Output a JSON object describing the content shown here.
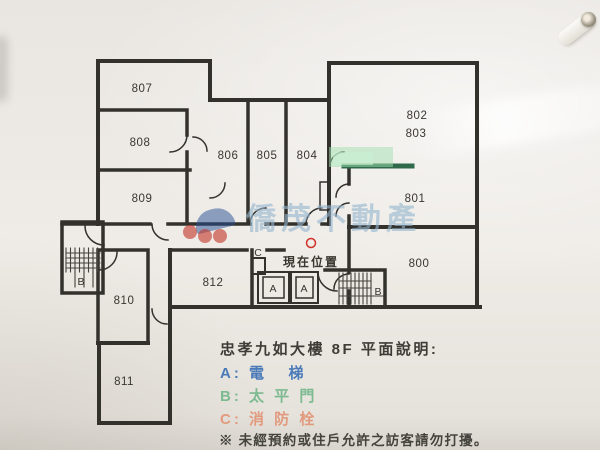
{
  "floor_plan": {
    "rooms": [
      {
        "number": "807"
      },
      {
        "number": "808"
      },
      {
        "number": "809"
      },
      {
        "number": "806"
      },
      {
        "number": "805"
      },
      {
        "number": "804"
      },
      {
        "number": "802"
      },
      {
        "number": "803"
      },
      {
        "number": "801"
      },
      {
        "number": "800"
      },
      {
        "number": "810"
      },
      {
        "number": "811"
      },
      {
        "number": "812"
      }
    ],
    "stairwell_left_label": "B",
    "stairwell_right_label": "B",
    "fire_hydrant_label": "C",
    "elevator_labels": [
      "A",
      "A"
    ],
    "current_location": {
      "text": "現在位置",
      "color": "#d23028"
    },
    "highlight_color": "#8fd9a5",
    "wall_color": "#33312c"
  },
  "watermark": {
    "text": "僑茂不動產",
    "logo_blue": "#264e94",
    "logo_red": "#c4382c"
  },
  "info": {
    "title": "忠孝九如大樓 8F 平面說明:",
    "legend": [
      {
        "key": "A:",
        "label": "電   梯",
        "color": "#4a7ab8"
      },
      {
        "key": "B:",
        "label": "太 平 門",
        "color": "#7cba90"
      },
      {
        "key": "C:",
        "label": "消 防 栓",
        "color": "#e29a7e"
      }
    ],
    "note": "※ 未經預約或住戶允許之訪客請勿打擾。"
  }
}
